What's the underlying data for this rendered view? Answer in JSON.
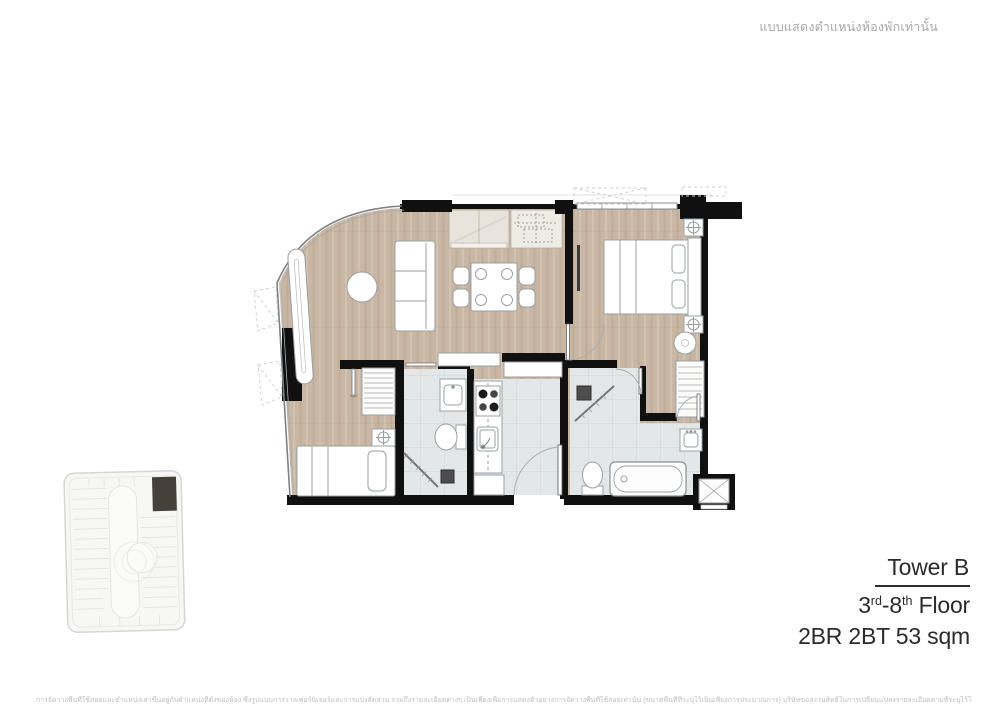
{
  "page": {
    "top_note": "แบบแสดงตำแหน่งห้องพักเท่านั้น",
    "disclaimer": "การจัดวางพื้นที่ใช้สอยและตำแหน่งเสาขึ้นอยู่กับตำแหน่งที่ตั้งของห้อง ซึ่งรูปแบบการวางเฟอร์นิเจอร์และการแบ่งสัดส่วน รวมถึงรายละเอียดต่างๆ เป็นเพียงเพื่อการแสดงตัวอย่างการจัดวางพื้นที่ใช้สอยเท่านั้น (ขนาดพื้นที่ที่ระบุไว้เป็นเพียงการประมาณการ) บริษัทขอสงวนสิทธิ์ในการเปลี่ยนแปลงรายละเอียดตามที่ระบุไว้โดยไม่ต้องแจ้งให้ทราบล่วงหน้า"
  },
  "unit_info": {
    "tower": "Tower B",
    "floor": {
      "num1": "3",
      "sup1": "rd",
      "dash_num2": "-8",
      "sup2": "th",
      "suffix": " Floor"
    },
    "spec": "2BR 2BT 53 sqm"
  },
  "colors": {
    "wood": "#c9b6a3",
    "tile": "#e4e7e8",
    "wall": "#101010",
    "glass": "#7d8285",
    "furn_stroke": "#9aa0a3",
    "text_dark": "#2b2b2b",
    "text_muted": "#a8a8a8",
    "disclaimer": "#bdbdbd",
    "keyplan_highlight": "#45403a"
  }
}
